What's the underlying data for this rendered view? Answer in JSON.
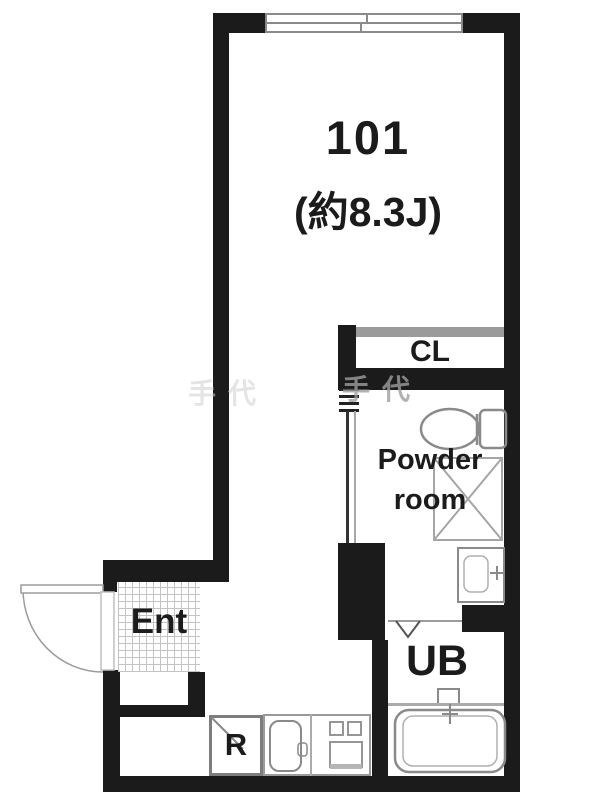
{
  "plan": {
    "type": "apartment-floor-plan",
    "labels": {
      "unit_number": "101",
      "unit_size": "(約8.3J)",
      "closet": "CL",
      "powder_line1": "Powder",
      "powder_line2": "room",
      "entrance": "Ent",
      "unit_bath": "UB",
      "refrigerator": "R",
      "watermark": "手代"
    },
    "colors": {
      "wall": "#1b1b1b",
      "fixture_line": "#8a8a8a",
      "closet_track": "#9b9b9b",
      "entrance_hatch": "#c3c3c3",
      "watermark": "#b5b5b5"
    },
    "fixtures": [
      "sliding-window",
      "entry-door-swing",
      "closet-sliding-track",
      "powder-room-sliding-door",
      "toilet",
      "washing-machine-space",
      "washbasin",
      "unit-bath-folding-door",
      "bathtub",
      "kitchen-sink",
      "stove",
      "refrigerator-space"
    ]
  }
}
